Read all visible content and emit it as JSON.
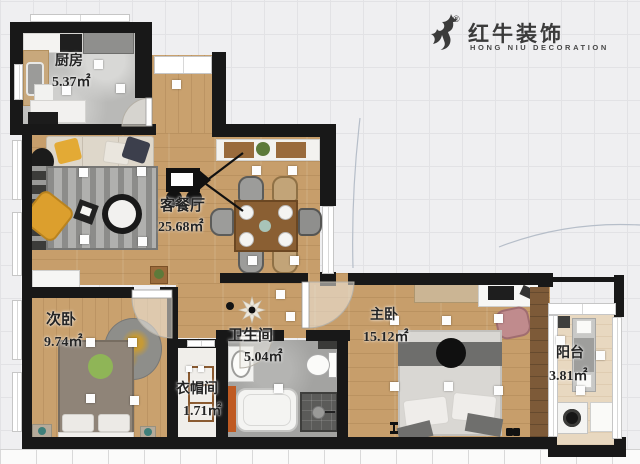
{
  "logo": {
    "brand": "红牛装饰",
    "subtitle": "HONG NIU DECORATION",
    "registered": "®",
    "icon": "bull-brushstroke-icon",
    "color": "#3b3b3b"
  },
  "rooms": [
    {
      "id": "kitchen",
      "name": "厨房",
      "area": "5.37㎡"
    },
    {
      "id": "living-dining",
      "name": "客餐厅",
      "area": "25.68㎡"
    },
    {
      "id": "second-bedroom",
      "name": "次卧",
      "area": "9.74㎡"
    },
    {
      "id": "bathroom",
      "name": "卫生间",
      "area": "5.04㎡"
    },
    {
      "id": "cloakroom",
      "name": "衣帽间",
      "area": "1.71㎡"
    },
    {
      "id": "master-bedroom",
      "name": "主卧",
      "area": "15.12㎡"
    },
    {
      "id": "balcony",
      "name": "阳台",
      "area": "3.81㎡"
    }
  ],
  "palette": {
    "wall": "#181818",
    "wood_floor": "#c79e6b",
    "kitchen_floor": "#b9b9b7",
    "bathroom_floor": "#a8a8a6",
    "balcony_floor": "#e8d8c0",
    "cloakroom_floor": "#f0eeea",
    "accent_yellow": "#dda32f",
    "rug_gray": "#a3a3a1",
    "background_grid": "#efeff1"
  }
}
